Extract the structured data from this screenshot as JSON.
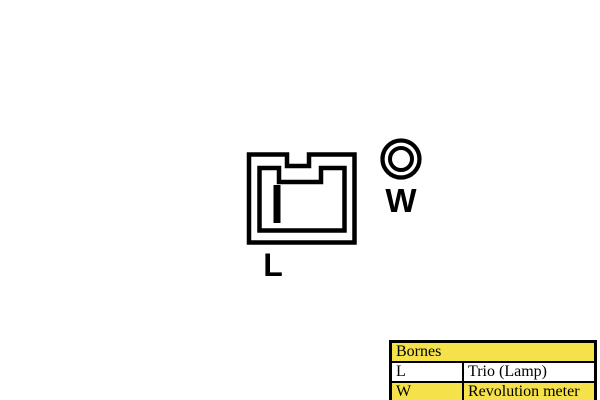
{
  "terminals": [
    {
      "id": "L",
      "label": "L",
      "symbol": "connector-blade"
    },
    {
      "id": "W",
      "label": "W",
      "symbol": "stud-ring"
    }
  ],
  "legend": {
    "header": "Bornes",
    "rows": [
      {
        "terminal": "L",
        "description": "Trio (Lamp)"
      },
      {
        "terminal": "W",
        "description": "Revolution meter"
      }
    ]
  },
  "colors": {
    "highlight_yellow": "#F5E14A",
    "line_black": "#000000"
  }
}
